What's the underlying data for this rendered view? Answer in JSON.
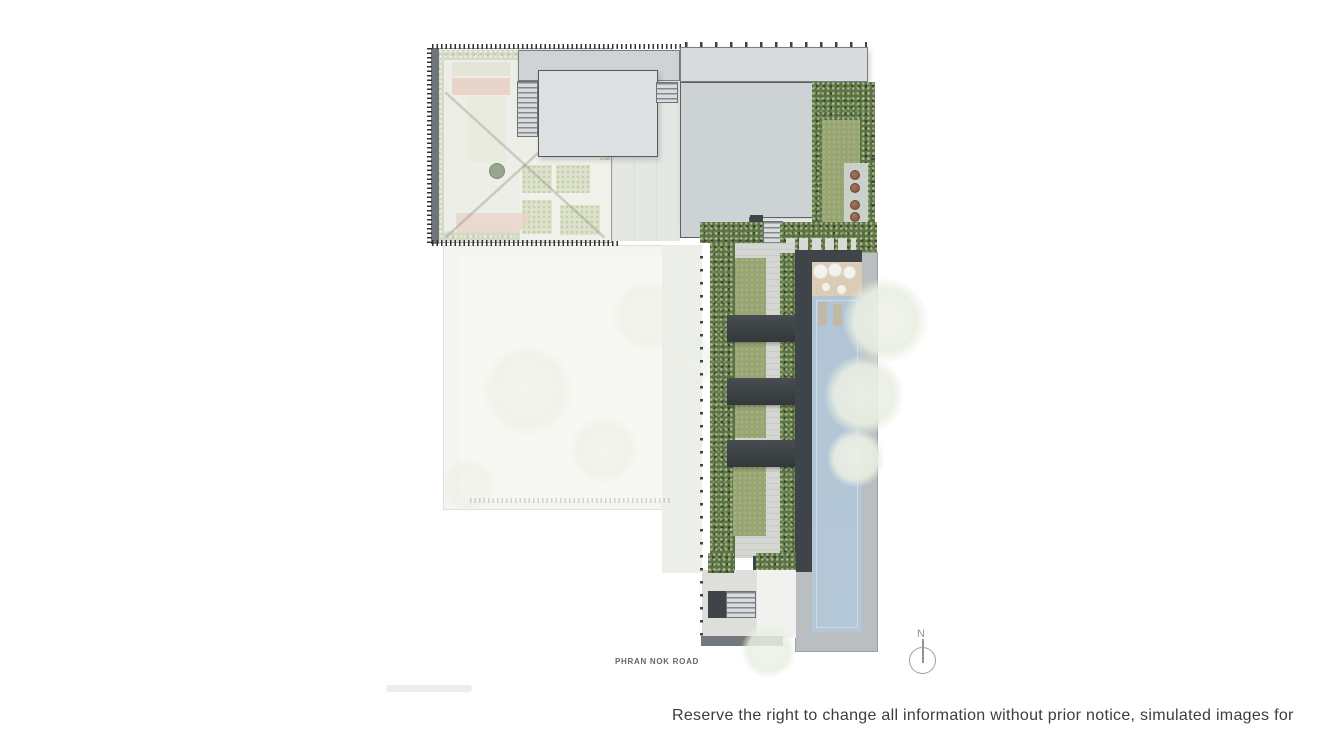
{
  "labels": {
    "road": "PHRAN NOK ROAD",
    "north": "N"
  },
  "footer": {
    "disclaimer": "Reserve the right to change all information without prior notice, simulated images for"
  },
  "colors": {
    "hedge-green": "#5c7245",
    "lawn-green": "#97a572",
    "pool-blue": "#b4c7d7",
    "pool-deck-gray": "#b9bec1",
    "pergola-dark": "#3c4245",
    "roof-gray": "#cdd2d5",
    "roof-light": "#dde0e2",
    "planter-brown": "#8a5c47",
    "sand-deck": "#dbccb6"
  }
}
